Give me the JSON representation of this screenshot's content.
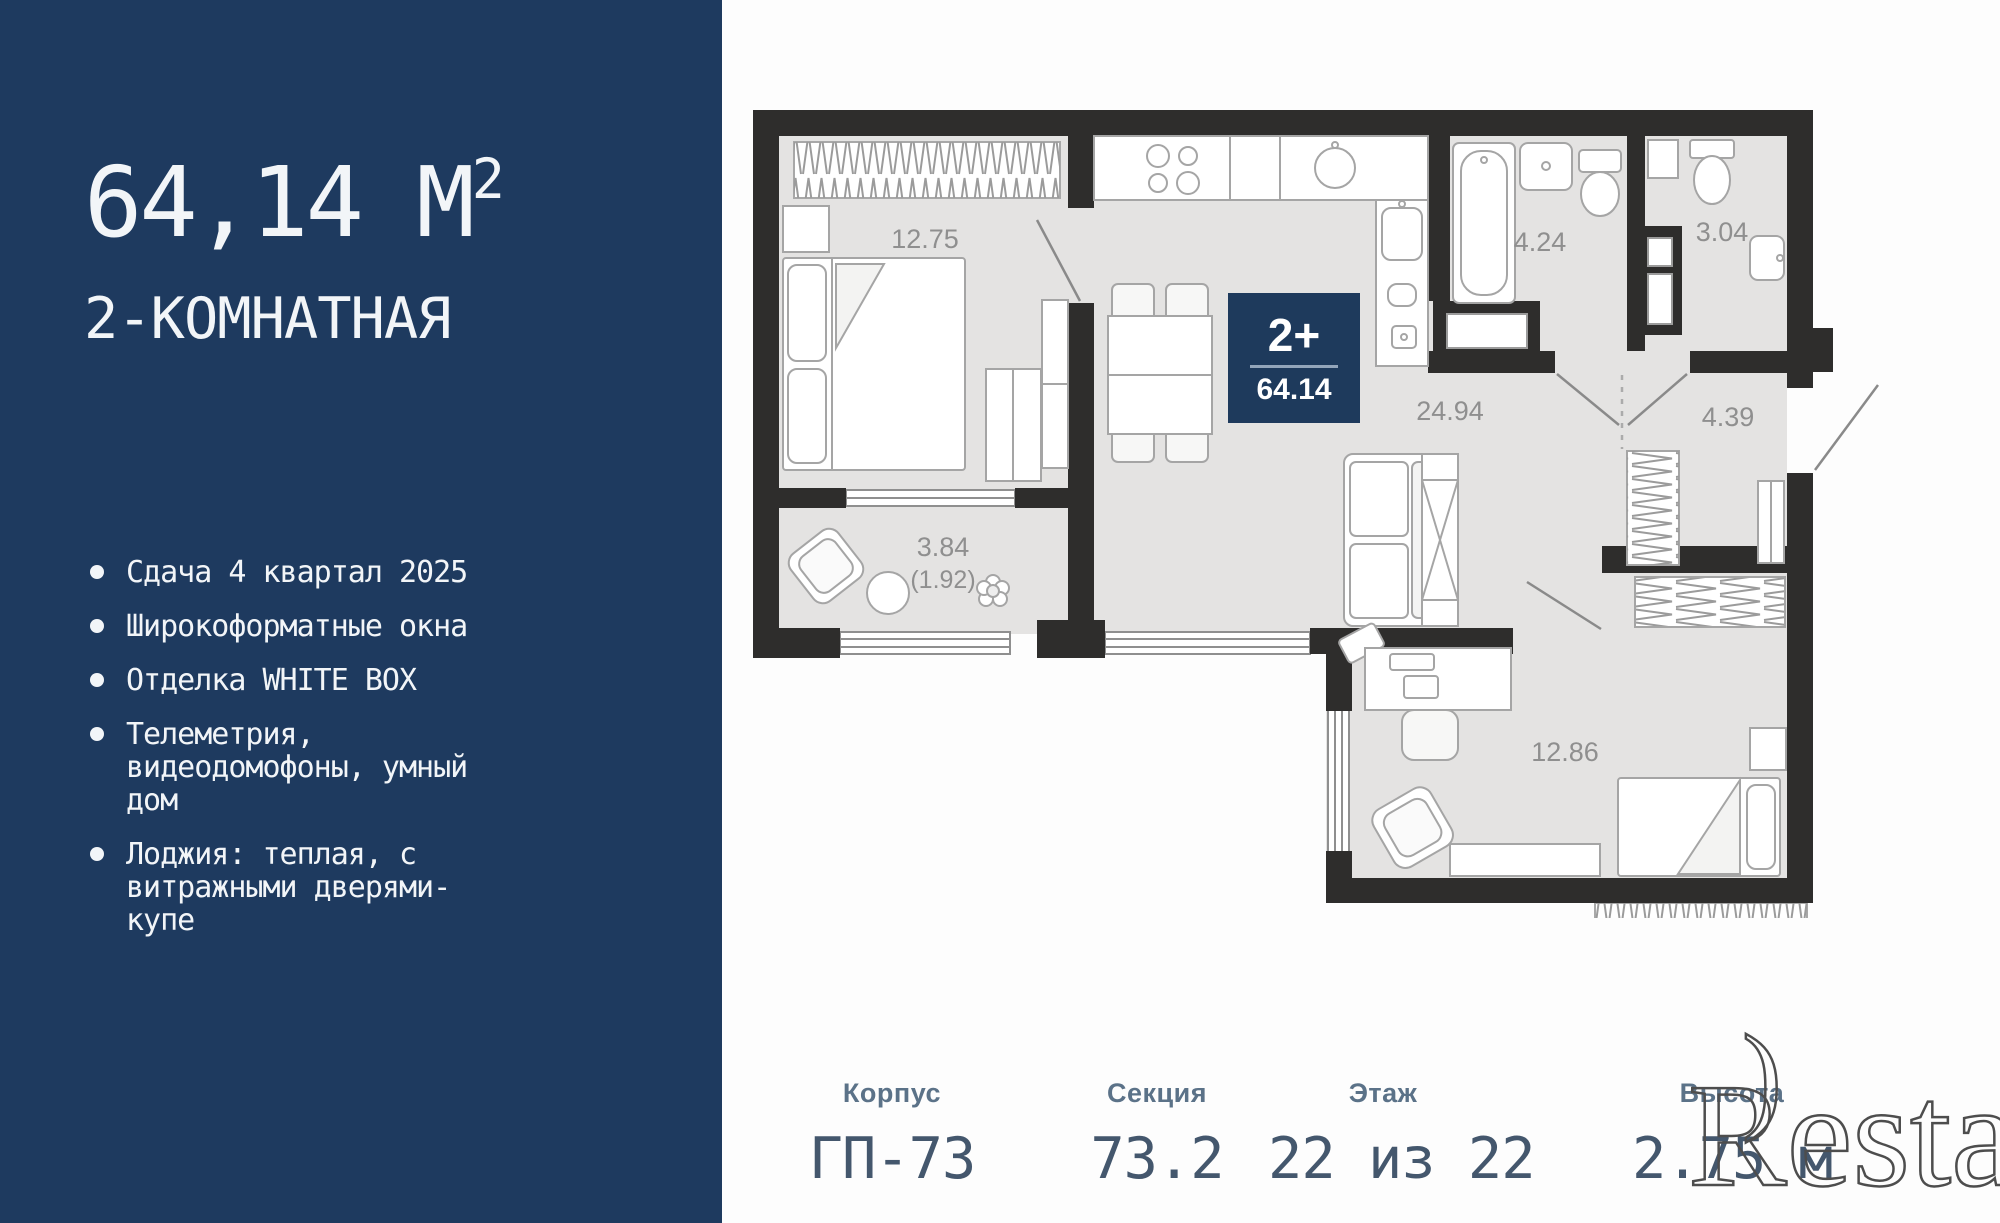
{
  "sidebar": {
    "area_value": "64,14 М",
    "area_sup": "2",
    "subtitle": "2-КОМНАТНАЯ",
    "bullets": [
      "Сдача 4 квартал 2025",
      "Широкоформатные окна",
      "Отделка WHITE BOX",
      "Телеметрия, видеодомофоны, умный дом",
      "Лоджия: теплая, с витражными дверями-купе"
    ]
  },
  "plan": {
    "badge": {
      "type": "2+",
      "area": "64.14"
    },
    "rooms": {
      "bedroom1": "12.75",
      "loggia": "3.84",
      "loggia_half": "(1.92)",
      "kitchen_living": "24.94",
      "bathroom": "4.24",
      "wc": "3.04",
      "hall": "4.39",
      "bedroom2": "12.86"
    }
  },
  "stats": [
    {
      "label": "Корпус",
      "value": "ГП-73"
    },
    {
      "label": "Секция",
      "value": "73.2"
    },
    {
      "label": "Этаж",
      "value": "22 из 22"
    },
    {
      "label": "Высота",
      "value": "2.75 м"
    }
  ],
  "watermark": {
    "text": "Restate",
    "flourish": ")"
  },
  "colors": {
    "sidebar_bg": "#1e3a5f",
    "badge_bg": "#1e3a5c",
    "wall": "#2e2d2c",
    "floor": "#e4e3e2"
  }
}
